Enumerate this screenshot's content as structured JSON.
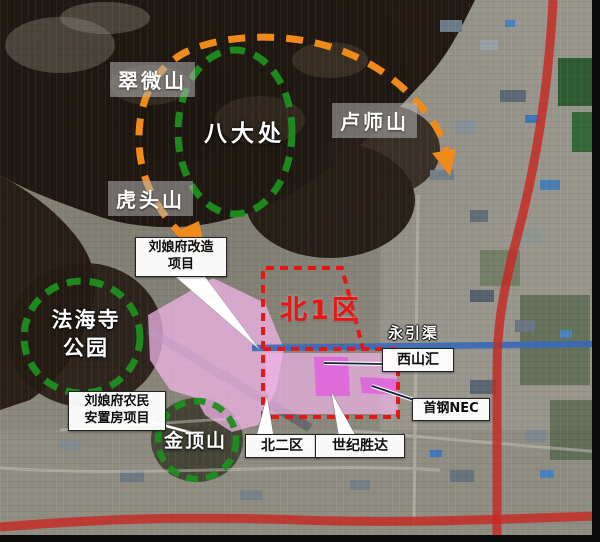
{
  "map": {
    "kind": "satellite-planning-map",
    "colors": {
      "scenic_circle_green": "#1e8f1e",
      "route_arc_orange": "#f08a1a",
      "zone_boundary_red": "#e81515",
      "road_red": "#c62a22",
      "canal_blue": "#3a6ab8",
      "project_area_pink": "#f0b4e8",
      "highlight_magenta": "#e060dd",
      "callout_bg": "#ffffff",
      "peak_label_bg_gray": "#b2b2b2"
    }
  },
  "labels": {
    "cuiweishan": "翠微山",
    "badachu": "八大处",
    "lushishan": "卢师山",
    "hutoushan": "虎头山",
    "fahaisi_line1": "法海寺",
    "fahaisi_line2": "公园",
    "jindingshan": "金顶山",
    "north_zone1": "北1区",
    "yongyin_canal": "永引渠",
    "xishanhui": "西山汇",
    "shougang_nec": "首钢NEC",
    "liuniangfu_renewal_line1": "刘娘府改造",
    "liuniangfu_renewal_line2": "项目",
    "resettlement_line1": "刘娘府农民",
    "resettlement_line2": "安置房项目",
    "north_zone2": "北二区",
    "shiji_shengda": "世纪胜达"
  }
}
